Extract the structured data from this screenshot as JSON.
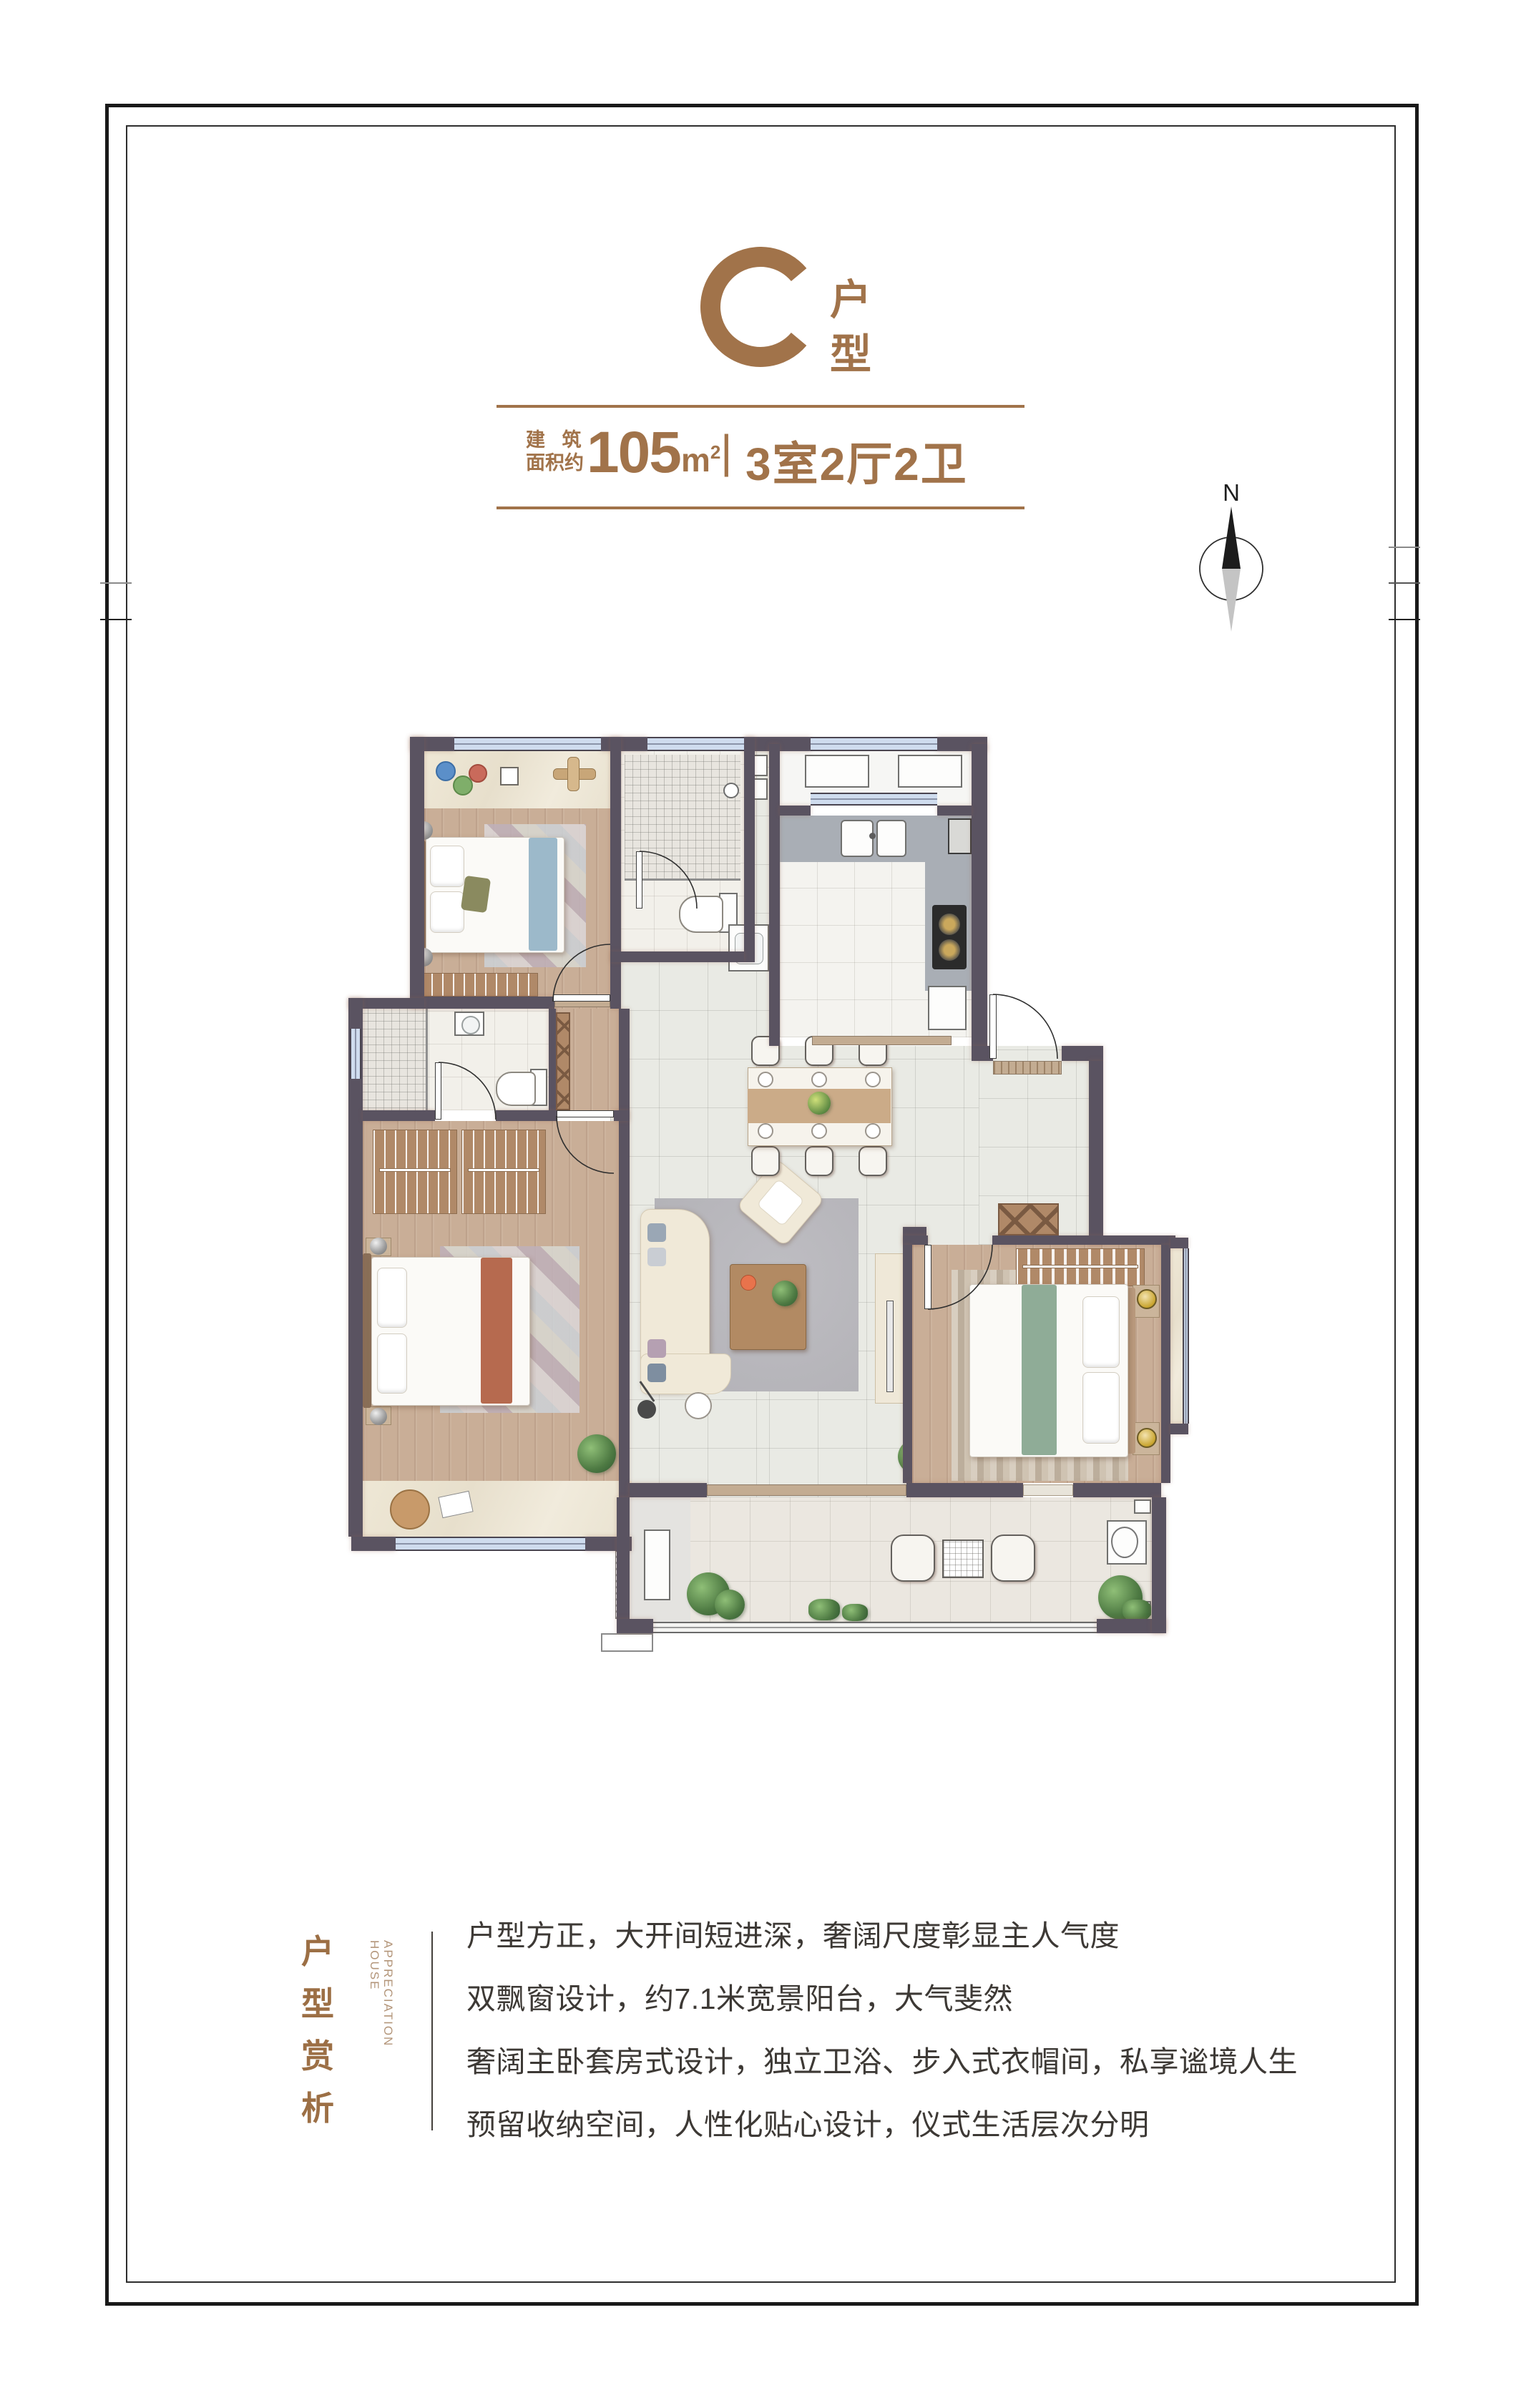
{
  "header": {
    "unit_letter": "C",
    "unit_type_chars": [
      "户",
      "型"
    ],
    "area_prefix_line1": "建 筑",
    "area_prefix_line2": "面积约",
    "area_number": "105",
    "area_unit_base": "m",
    "area_unit_exponent": "2",
    "separator": "|",
    "rooms_text": "3室2厅2卫",
    "accent_color": "#a1734a"
  },
  "compass": {
    "north_label": "N"
  },
  "floorplan": {
    "colors": {
      "wall": "#5a5361",
      "wood_floor": "#c9ae97",
      "tile_floor": "#e9eae4",
      "bath_floor": "#f2f0ea",
      "kitchen_counter": "#a9aeb5",
      "window_glass": "#cfdcee",
      "balcony_floor": "#ebe7e0",
      "threshold": "#c3ac92",
      "cabinet_wood": "#b08968"
    }
  },
  "footer": {
    "section_title_chars": [
      "户",
      "型",
      "赏",
      "析"
    ],
    "section_subtitle_lines": [
      "HOUSE",
      "APPRECIATION"
    ],
    "description_lines": [
      "户型方正，大开间短进深，奢阔尺度彰显主人气度",
      "双飘窗设计，约7.1米宽景阳台，大气斐然",
      "奢阔主卧套房式设计，独立卫浴、步入式衣帽间，私享谧境人生",
      "预留收纳空间，人性化贴心设计，仪式生活层次分明"
    ]
  }
}
